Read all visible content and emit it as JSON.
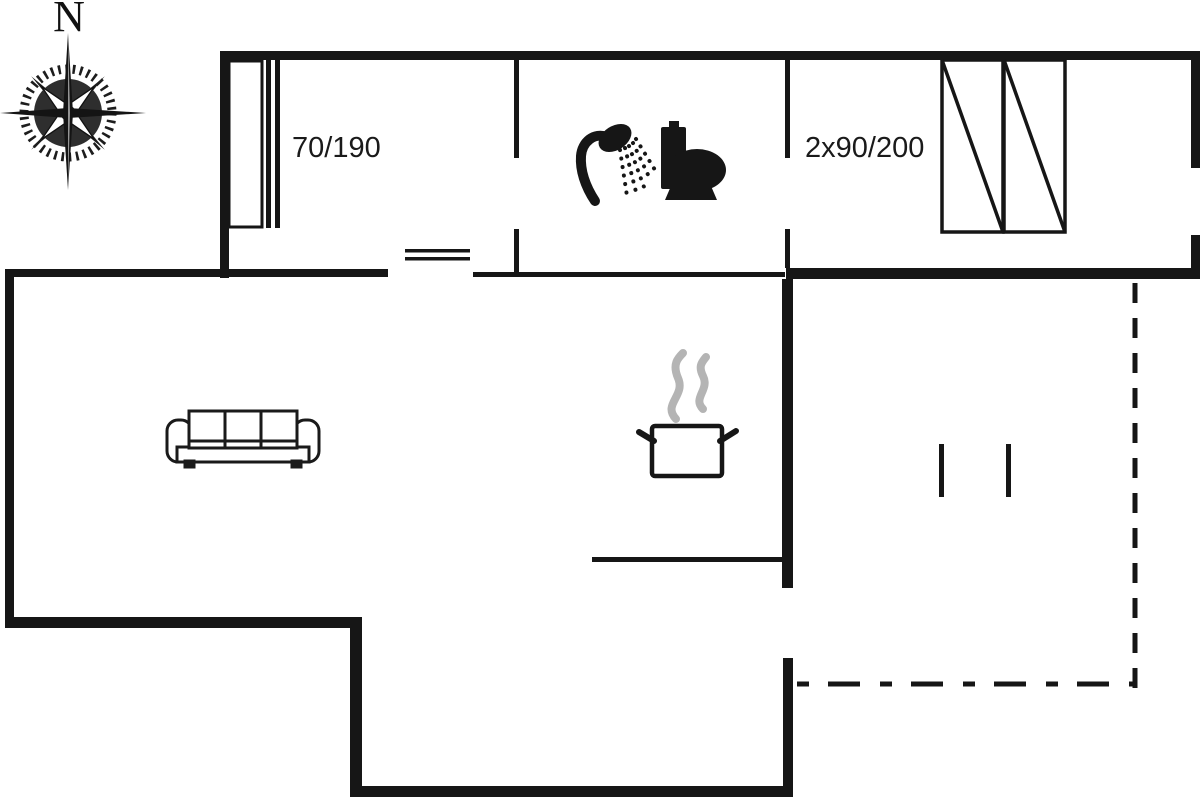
{
  "canvas": {
    "width": 1200,
    "height": 800,
    "background": "#ffffff"
  },
  "colors": {
    "wall": "#161616",
    "icon": "#161616",
    "steam": "#b4b4b4",
    "label_text": "#1a1a1a"
  },
  "compass": {
    "north_label": "N"
  },
  "annotations": {
    "door_size_label": "70/190",
    "bed_size_label": "2x90/200"
  },
  "symbols": [
    {
      "name": "compass-rose-icon"
    },
    {
      "name": "wardrobe-symbol"
    },
    {
      "name": "sliding-door-symbol"
    },
    {
      "name": "window-symbol"
    },
    {
      "name": "shower-icon"
    },
    {
      "name": "toilet-icon"
    },
    {
      "name": "bed-symbol",
      "count": 2
    },
    {
      "name": "sofa-icon"
    },
    {
      "name": "cooking-pot-icon"
    },
    {
      "name": "terrace-dashed-boundary"
    },
    {
      "name": "terrace-post-marks",
      "count": 2
    }
  ]
}
